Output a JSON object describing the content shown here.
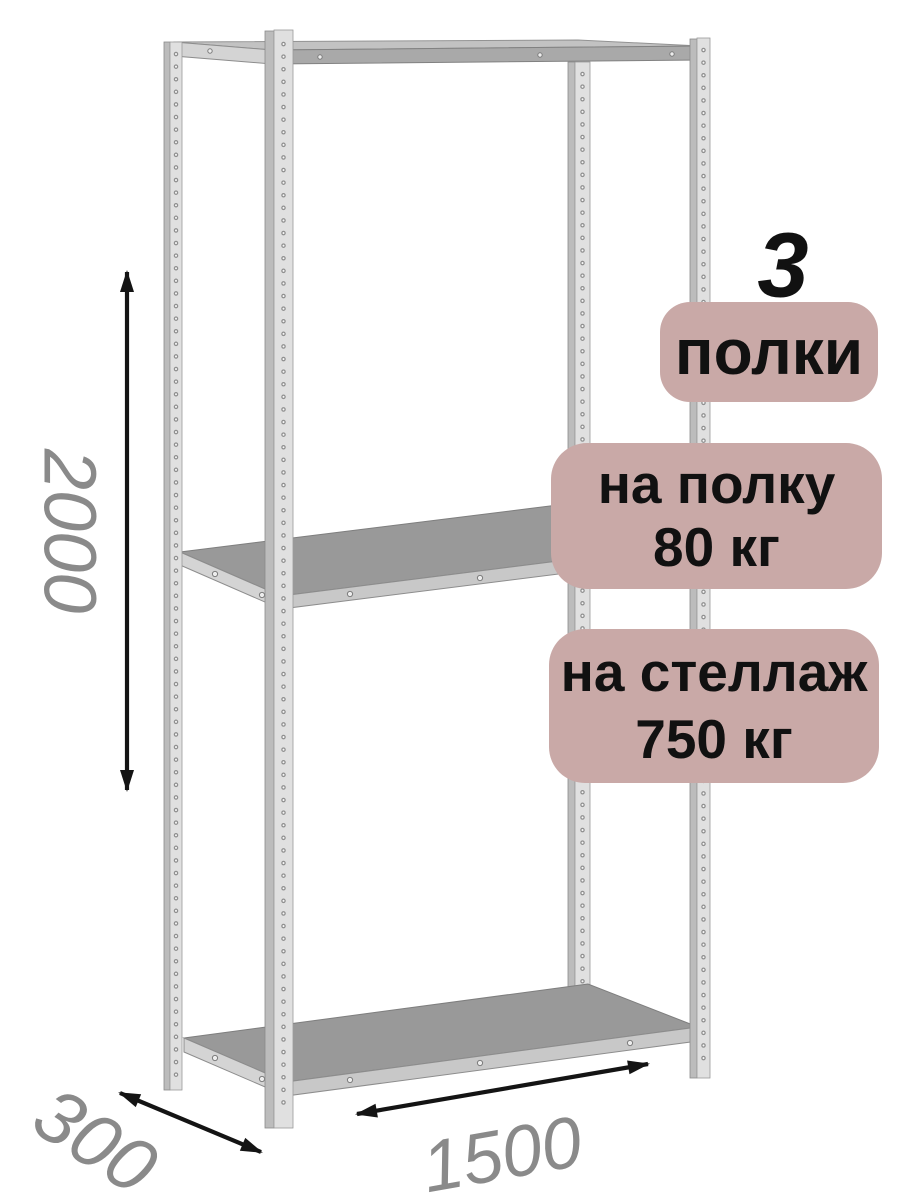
{
  "dimensions": {
    "height": "2000",
    "depth": "300",
    "width": "1500"
  },
  "annotations": {
    "shelf_count": {
      "number": "3",
      "label": "полки"
    },
    "shelf_load": {
      "line1": "на полку",
      "line2": "80 кг"
    },
    "rack_load": {
      "line1": "на стеллаж",
      "line2": "750 кг"
    }
  },
  "colors": {
    "badge_background": "#c9a9a7",
    "annotation_text": "#111111",
    "dimension_text": "#8a8a8a",
    "arrow": "#141414",
    "metal_light": "#e0e0e0",
    "metal_mid": "#c8c8c8",
    "shelf_top": "#999999",
    "background": "#ffffff"
  }
}
